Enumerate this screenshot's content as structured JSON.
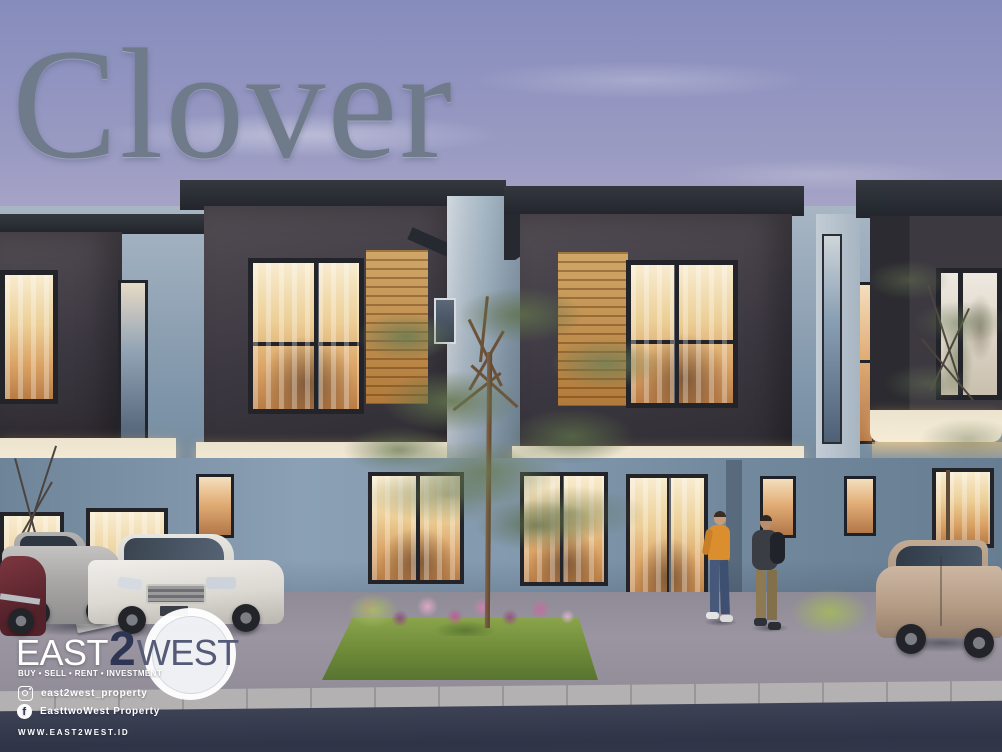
{
  "page": {
    "title": "Clover"
  },
  "brand": {
    "name_east": "EAST",
    "name_two": "2",
    "name_west": "WEST",
    "tagline": "BUY • SELL • RENT • INVESTMENT",
    "instagram_handle": "east2west_property",
    "facebook_handle": "EasttwoWest Property",
    "facebook_icon_letter": "f",
    "website": "WWW.EAST2WEST.ID"
  },
  "scene": {
    "description": "Twilight architectural render of modern two-storey Clover townhouses: charcoal upper volumes with timber slat accents and warm glowing windows, blue-grey lower walls, a slender tree on a front lawn with a pink flower bed, parked cars on both sides, and two people talking on the driveway.",
    "objects": [
      "townhouse-row",
      "center-tree",
      "right-tree",
      "front-lawn",
      "flower-bed",
      "maroon-car",
      "silver-hatchback",
      "white-sedan",
      "beige-hatchback",
      "person-orange-sweater",
      "person-backpack",
      "street-curb",
      "asphalt-road"
    ]
  },
  "palette": {
    "sky_top": "#868cbc",
    "sky_horizon": "#f2e6da",
    "title_text": "#6f7b8b",
    "roof": "#22252c",
    "upper_volume": "#3c3841",
    "timber": "#b27a3a",
    "wall": "#8399ae",
    "pillar": "#8aa0b2",
    "window_glow": "#dba365",
    "soffit": "#f6ecd6",
    "lawn": "#6d8a38",
    "road": "#343a4e",
    "logo_navy": "#2d3552",
    "logo_slate": "#555a76",
    "white": "#ffffff"
  }
}
